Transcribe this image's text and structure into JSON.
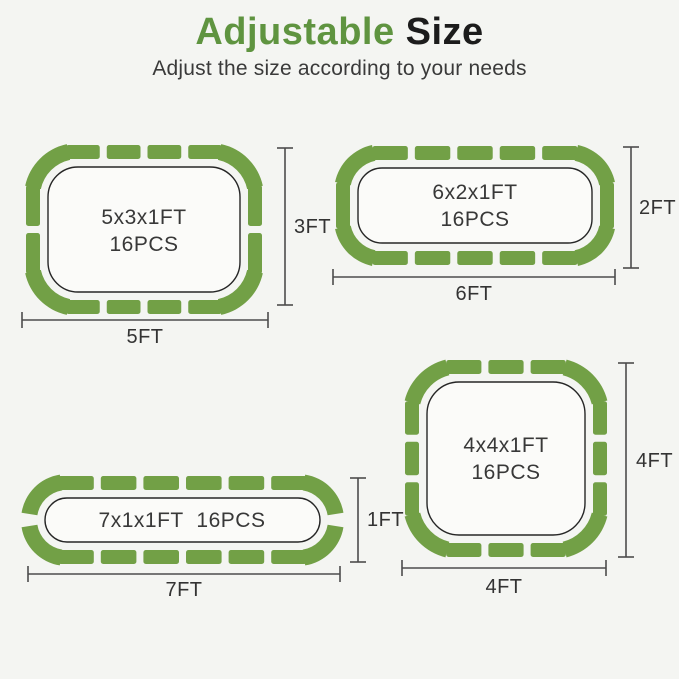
{
  "header": {
    "title_accent": "Adjustable",
    "title_rest": "Size",
    "subtitle": "Adjust the size according to your needs"
  },
  "colors": {
    "background": "#f4f5f2",
    "tile_green": "#72a046",
    "accent_green": "#5f9440",
    "outline_dark": "#262626",
    "dim_line": "#4c4c4c",
    "inner_fill": "#fbfbf9"
  },
  "diagrams": [
    {
      "name": "5x3x1ft",
      "label_line1": "5x3x1FT",
      "label_line2": "16PCS",
      "width_label": "5FT",
      "height_label": "3FT",
      "total_pieces": 16,
      "pieces": {
        "top": 4,
        "bottom": 4,
        "left": 2,
        "right": 2,
        "corners": 4
      }
    },
    {
      "name": "6x2x1ft",
      "label_line1": "6x2x1FT",
      "label_line2": "16PCS",
      "width_label": "6FT",
      "height_label": "2FT",
      "total_pieces": 16,
      "pieces": {
        "top": 5,
        "bottom": 5,
        "left": 1,
        "right": 1,
        "corners": 4
      }
    },
    {
      "name": "7x1x1ft",
      "label_line1": "7x1x1FT  16PCS",
      "label_line2": "",
      "width_label": "7FT",
      "height_label": "1FT",
      "total_pieces": 16,
      "pieces": {
        "top": 6,
        "bottom": 6,
        "left": 0,
        "right": 0,
        "corners": 4
      }
    },
    {
      "name": "4x4x1ft",
      "label_line1": "4x4x1FT",
      "label_line2": "16PCS",
      "width_label": "4FT",
      "height_label": "4FT",
      "total_pieces": 16,
      "pieces": {
        "top": 3,
        "bottom": 3,
        "left": 3,
        "right": 3,
        "corners": 4
      }
    }
  ]
}
